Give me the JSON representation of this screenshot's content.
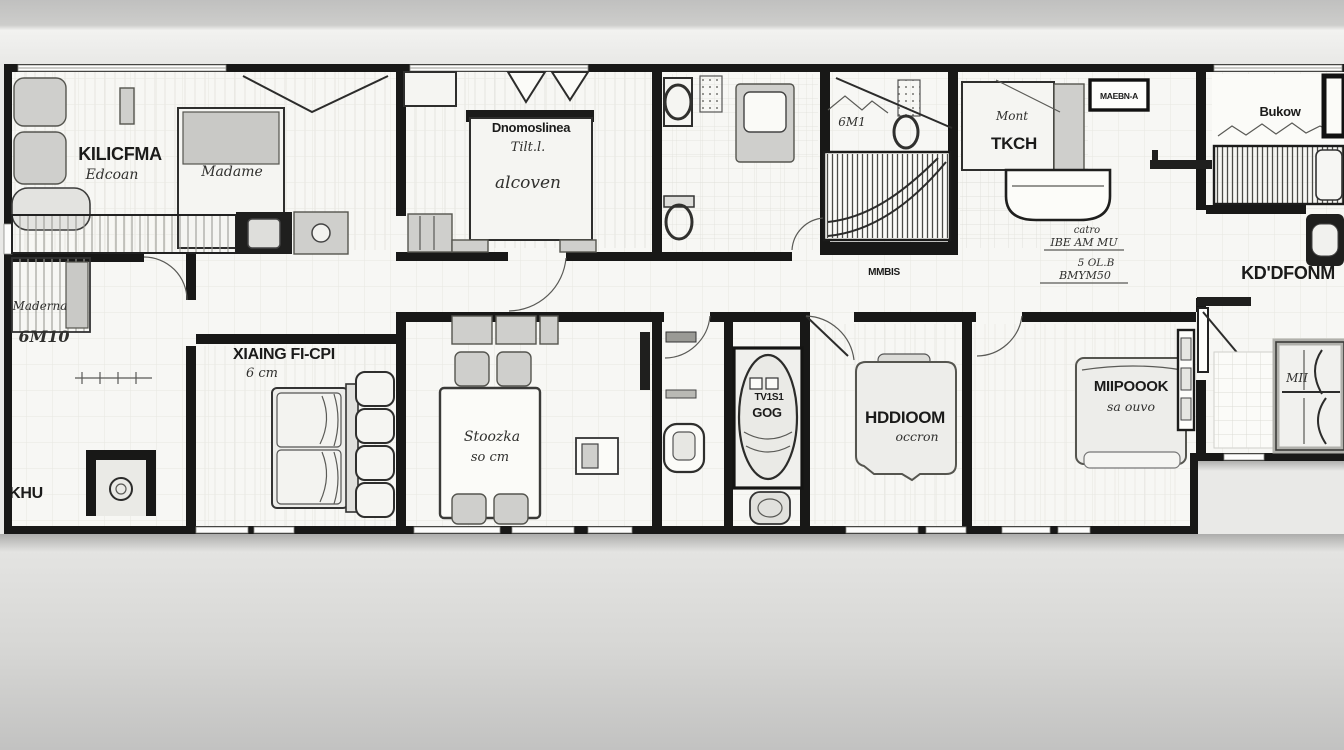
{
  "scene": {
    "type": "hand-drawn apartment floor plan sketch, black ink on white paper, photographed on a gray wall"
  },
  "colors": {
    "wall_ink": "#181817",
    "paper": "#f7f7f4",
    "furniture_gray": "#e3e3e0",
    "background_top": "#c3c3c3",
    "background_bottom": "#d3d3d1"
  },
  "rooms": {
    "kitchen_suite": {
      "title": "KILICFMA",
      "subtitle": "Edcoan",
      "bed_label": "Madame"
    },
    "master_bedroom": {
      "bed_title": "Dnomoslinea",
      "bed_script_1": "Tilt.l.",
      "bed_script_2": "alcoven"
    },
    "small_bath": {
      "wall_sketch_note": "6M1"
    },
    "tkch": {
      "script_note": "Mont",
      "title": "TKCH",
      "wall_box_label": "MAEBN-A"
    },
    "balcony_room": {
      "title": "Bukow"
    },
    "right_bedroom_suite": {
      "door_label": "KD'DFONM"
    },
    "left_bedroom": {
      "bed_script": "Maderna",
      "bed_code": "6M10",
      "corner_label": "KHU"
    },
    "living_room": {
      "title": "XIAING FI-CPI",
      "subtitle": "6 cm"
    },
    "dining_room": {
      "table_title": "Stoozka",
      "table_subtitle": "so cm"
    },
    "bathroom": {
      "tub_line1": "TV1S1",
      "tub_line2": "GOG"
    },
    "bedroom_center": {
      "title": "HDDIOOM",
      "subtitle": "occron"
    },
    "bedroom_right": {
      "title": "MIIPOOOK",
      "subtitle": "sa ouvo"
    },
    "right_wardrobe": {
      "script": "MII"
    }
  },
  "annotations": {
    "hall_note": "MMBIS",
    "dim_note_1a": "catro",
    "dim_note_1b": "IBE AM MU",
    "dim_note_2a": "5 OL.B",
    "dim_note_2b": "BMYM50"
  }
}
